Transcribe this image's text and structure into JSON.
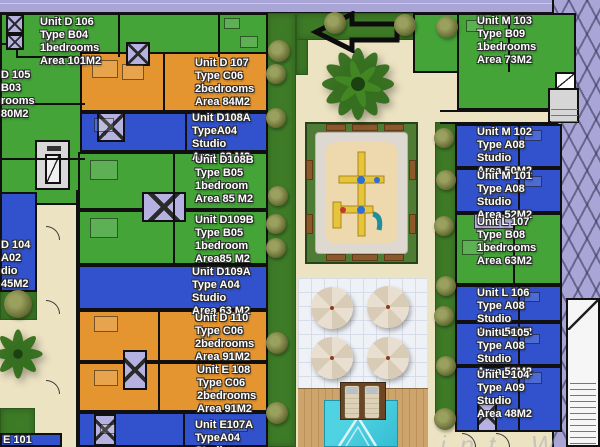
{
  "plan_title": "residential site plan",
  "colors": {
    "unit_green": "#44a438",
    "unit_orange": "#e5952f",
    "unit_blue": "#3152cc",
    "lavender": "#a9a5d6",
    "road": "#a9a5d6",
    "ground": "#ece3c2",
    "grass": "#3e7b27",
    "sand": "#eed9ae",
    "pool": "#3ccadd",
    "wood": "#c89f66",
    "wall": "#101010"
  },
  "units": {
    "d106": {
      "color": "unit_green",
      "lines": [
        "Unit D 106",
        "Type B04",
        "1bedrooms",
        "Area 101M2"
      ]
    },
    "d105": {
      "color": "unit_green",
      "lines": [
        "D 105",
        "B03",
        "rooms",
        "80M2"
      ]
    },
    "d107": {
      "color": "unit_orange",
      "lines": [
        "Unit D 107",
        "Type C06",
        "2bedrooms",
        "Area 84M2"
      ]
    },
    "d108a": {
      "color": "unit_blue",
      "lines": [
        "Unit D108A",
        "TypeA04",
        "Studio",
        "Area 63 M2"
      ]
    },
    "d108b": {
      "color": "unit_green",
      "lines": [
        "Unit D108B",
        "Type B05",
        "1bedroom",
        "Area 85 M2"
      ]
    },
    "d109b": {
      "color": "unit_green",
      "lines": [
        "Unit D109B",
        "Type B05",
        "1bedroom",
        "Area85 M2"
      ]
    },
    "d109a": {
      "color": "unit_blue",
      "lines": [
        "Unit D109A",
        "Type A04",
        "Studio",
        "Area 63 M2"
      ]
    },
    "d110": {
      "color": "unit_orange",
      "lines": [
        "Unit D 110",
        "Type C06",
        "2bedrooms",
        "Area 91M2"
      ]
    },
    "e108": {
      "color": "unit_orange",
      "lines": [
        "Unit E 108",
        "Type C06",
        "2bedrooms",
        "Area 91M2"
      ]
    },
    "e107a": {
      "color": "unit_blue",
      "lines": [
        "Unit E107A",
        "TypeA04",
        "Studio"
      ]
    },
    "d104": {
      "color": "unit_blue",
      "lines": [
        "D 104",
        "A02",
        "dio",
        "45M2"
      ]
    },
    "e101": {
      "color": "unit_blue",
      "lines": [
        "E 101"
      ]
    },
    "m103": {
      "color": "unit_green",
      "lines": [
        "Unit M 103",
        "Type B09",
        "1bedrooms",
        "Area 73M2"
      ]
    },
    "m102": {
      "color": "unit_blue",
      "lines": [
        "Unit M 102",
        "Type A08",
        "Studio",
        "Area 50M2"
      ]
    },
    "m101": {
      "color": "unit_blue",
      "lines": [
        "Unit M 101",
        "Type A08",
        "Studio",
        "Area 52M2"
      ]
    },
    "l107": {
      "color": "unit_green",
      "lines": [
        "Unit L 107",
        "Type B08",
        "1bedrooms",
        "Area 63M2"
      ]
    },
    "l106": {
      "color": "unit_blue",
      "lines": [
        "Unit L 106",
        "Type A08",
        "Studio",
        "Area 50M2"
      ]
    },
    "l105": {
      "color": "unit_blue",
      "lines": [
        "Unit L 105",
        "Type A08",
        "Studio",
        "Area 52M2"
      ]
    },
    "l104": {
      "color": "unit_blue",
      "lines": [
        "Unit L 104",
        "Type A09",
        "Studio",
        "Area 48M2"
      ]
    }
  },
  "watermark": "int W"
}
